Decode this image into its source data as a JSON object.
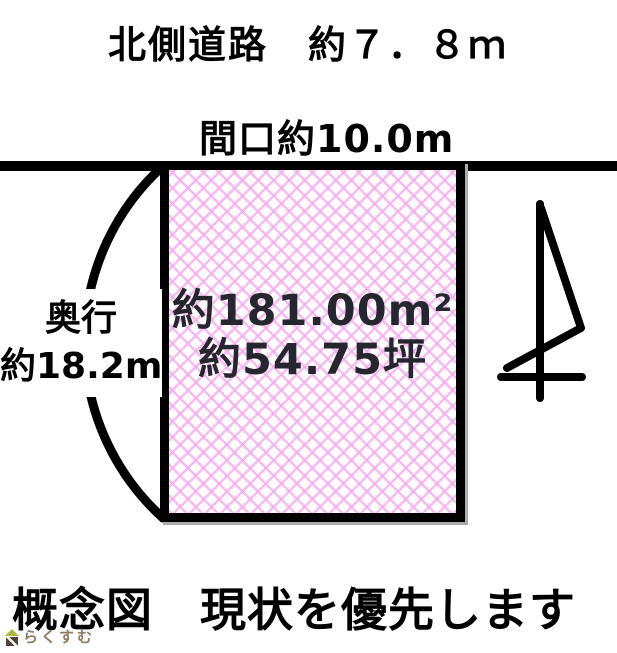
{
  "diagram": {
    "north_road_label": "北側道路　約７．８ｍ",
    "frontage_label": "間口約10.0m",
    "depth_label": {
      "line1": "奥行",
      "line2": "約18.2m"
    },
    "parcel": {
      "area_sqm_label": "約181.00m²",
      "area_tsubo_label": "約54.75坪"
    },
    "caption": "概念図　現状を優先します",
    "values": {
      "north_road_width_m": 7.8,
      "frontage_m": 10.0,
      "depth_m": 18.2,
      "area_m2": 181.0,
      "area_tsubo": 54.75
    }
  },
  "footer_logo": {
    "text": "らくすむ"
  },
  "icons": {
    "north_arrow_icon": "hand-drawn north arrow (shaft, flag, crossbar)",
    "depth_arc": "dimension arc bracket",
    "road_line": "road edge line",
    "rakusumu_house_icon": "house logo (green roof, brown base)"
  },
  "colors": {
    "ink": "#000000",
    "area_text": "#26262e",
    "hatch_pink": "#f2a8ee",
    "hatch_bg": "#fffcff",
    "logo_text": "#8d7c60",
    "logo_roof": "#a9ba3c",
    "logo_body": "#564334"
  }
}
